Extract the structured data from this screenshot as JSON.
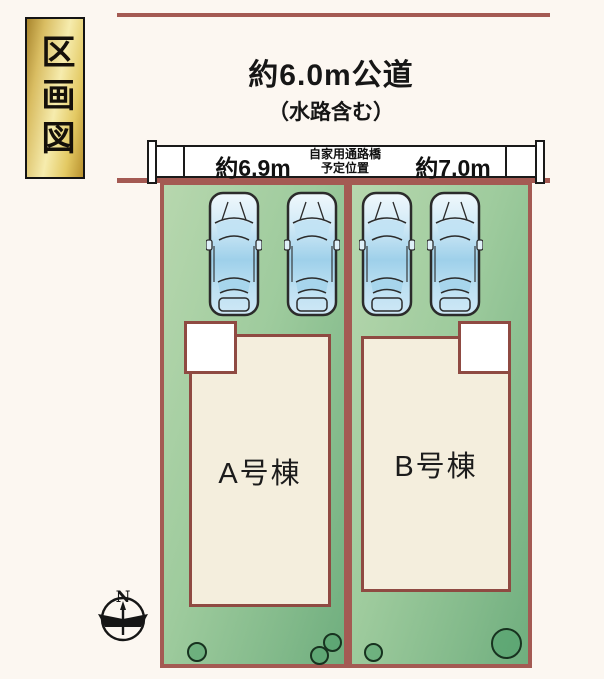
{
  "title": {
    "label": "区画図"
  },
  "road": {
    "label": "約6.0m公道",
    "sublabel": "（水路含む）"
  },
  "bridge": {
    "left_width": "約6.9m",
    "note_line1": "自家用通路橋",
    "note_line2": "予定位置",
    "right_width": "約7.0m"
  },
  "plots": [
    {
      "id": "A",
      "building_label": "A号棟",
      "cars": 2,
      "trees": 3
    },
    {
      "id": "B",
      "building_label": "B号棟",
      "cars": 2,
      "trees": 2
    }
  ],
  "compass": {
    "north_label": "N"
  },
  "colors": {
    "background": "#fcf7f1",
    "boundary_red": "#a45a53",
    "building_border": "#8f4a42",
    "building_fill": "#f4eedd",
    "plot_green_light": "#b7d7ae",
    "plot_green_dark": "#6fae7e",
    "badge_gold": "#e3c963",
    "car_blue": "#9ed0ea"
  }
}
